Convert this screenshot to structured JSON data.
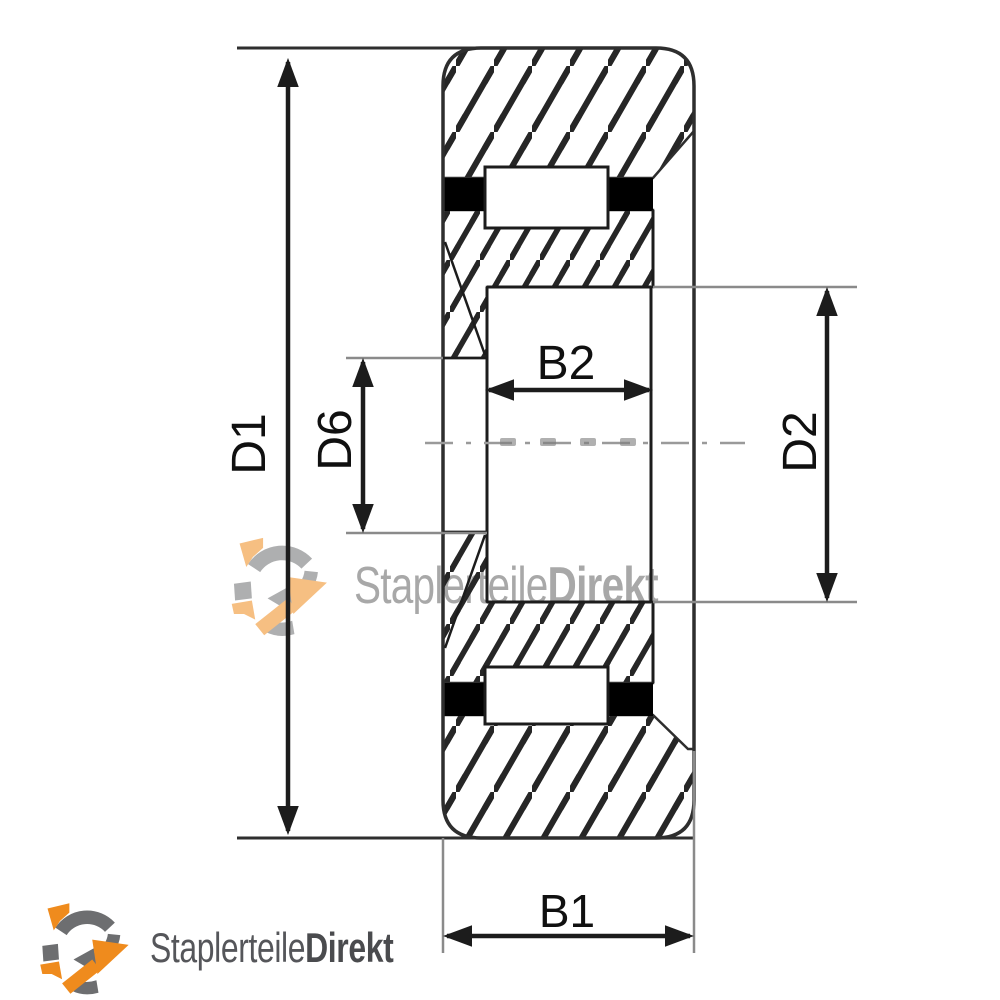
{
  "drawing": {
    "type": "wheel-cross-section-technical-drawing",
    "labels": {
      "d1": "D1",
      "d6": "D6",
      "b2": "B2",
      "d2": "D2",
      "b1": "B1"
    }
  },
  "watermark": {
    "brand_regular": "Staplerteile",
    "brand_bold": "Direkt"
  },
  "footer_logo": {
    "brand_regular": "Staplerteile",
    "brand_bold": "Direkt"
  },
  "colors": {
    "line": "#1c1c1c",
    "outline": "#2e2e2e",
    "extension": "#8a8a8a",
    "hatch": "#262626",
    "black_band": "#000000",
    "logo_orange": "#ef8b1d",
    "logo_gray": "#6d6e70",
    "logo_text": "#55565a",
    "watermark_gray": "#9a9a9a"
  }
}
